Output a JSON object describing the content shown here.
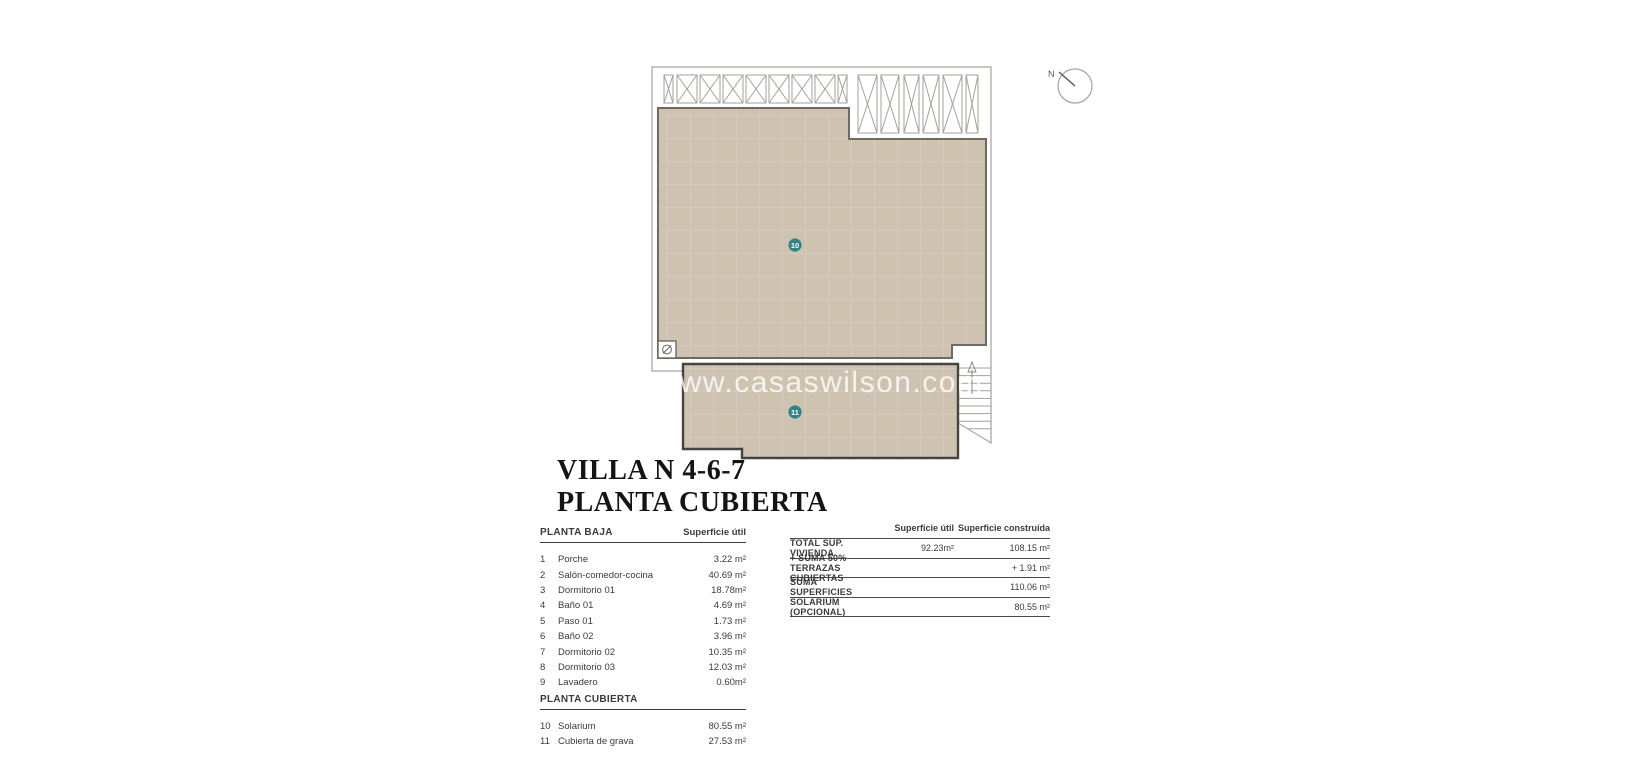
{
  "colors": {
    "roof_fill": "#cec3b0",
    "plan_line": "#a3a29b",
    "plan_dark": "#6e6a61",
    "plan_bold": "#45443e",
    "badge": "#2e8487",
    "ink": "#3b3b39",
    "title_ink": "#141414",
    "watermark": "#ffffff"
  },
  "plan": {
    "compass_label": "N",
    "watermark": "www.casaswilson.com",
    "badge_solarium": "10",
    "badge_gravel": "11"
  },
  "title": {
    "line1": "VILLA N 4-6-7",
    "line2": "PLANTA CUBIERTA"
  },
  "left_table": {
    "sections": [
      {
        "header": "PLANTA BAJA",
        "value_header": "Superficie útil",
        "rows": [
          {
            "num": "1",
            "label": "Porche",
            "value": "3.22 m²"
          },
          {
            "num": "2",
            "label": "Salón-comedor-cocina",
            "value": "40.69 m²"
          },
          {
            "num": "3",
            "label": "Dormitorio 01",
            "value": "18.78m²"
          },
          {
            "num": "4",
            "label": "Baño 01",
            "value": "4.69 m²"
          },
          {
            "num": "5",
            "label": "Paso 01",
            "value": "1.73 m²"
          },
          {
            "num": "6",
            "label": "Baño 02",
            "value": "3.96 m²"
          },
          {
            "num": "7",
            "label": "Dormitorio 02",
            "value": "10.35 m²"
          },
          {
            "num": "8",
            "label": "Dormitorio 03",
            "value": "12.03 m²"
          },
          {
            "num": "9",
            "label": "Lavadero",
            "value": "0.60m²"
          }
        ]
      },
      {
        "header": "PLANTA CUBIERTA",
        "value_header": "",
        "rows": [
          {
            "num": "10",
            "label": "Solarium",
            "value": "80.55 m²"
          },
          {
            "num": "11",
            "label": "Cubierta de grava",
            "value": "27.53 m²"
          }
        ]
      }
    ]
  },
  "summary_table": {
    "col_util": "Superficie útil",
    "col_built": "Superficie construída",
    "rows": [
      {
        "label": "TOTAL SUP. VIVIENDA",
        "util": "92.23m²",
        "built": "108.15 m²"
      },
      {
        "label": "+ SUMA 50% TERRAZAS CUBIERTAS",
        "util": "",
        "built": "+ 1.91 m²"
      },
      {
        "label": "SUMA SUPERFICIES",
        "util": "",
        "built": "110.06 m²"
      },
      {
        "label": "SOLARIUM (OPCIONAL)",
        "util": "",
        "built": "80.55 m²"
      }
    ]
  }
}
